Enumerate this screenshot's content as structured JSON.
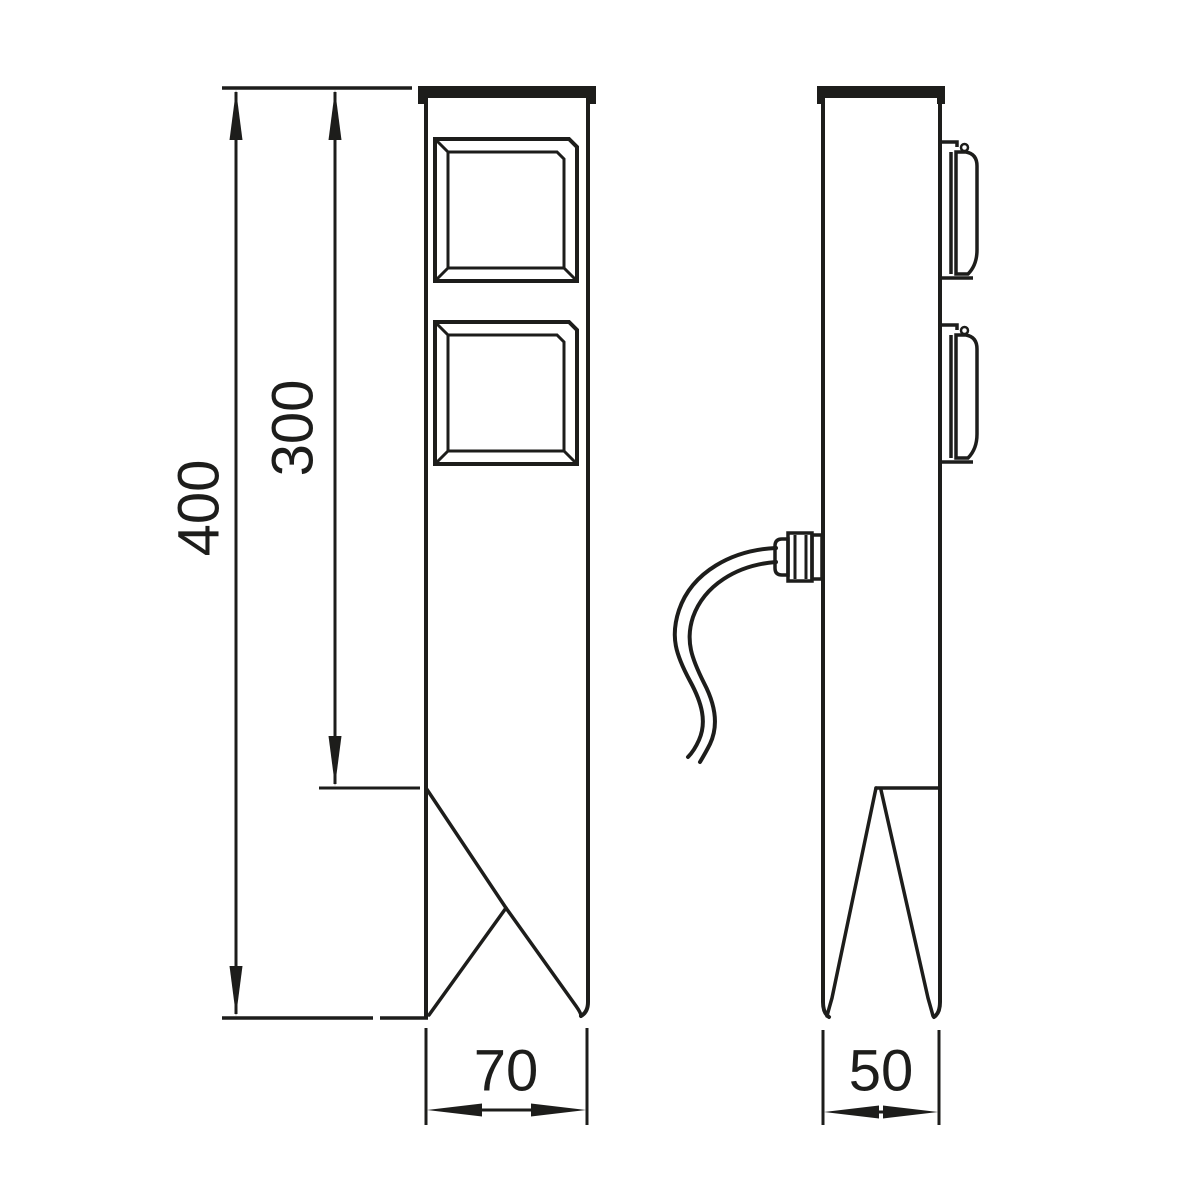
{
  "page": {
    "background": "#ffffff",
    "line_color": "#1d1d1b"
  },
  "drawing": {
    "kind": "technical-drawing-two-views",
    "views": {
      "front_view": "post-with-two-sockets-and-ground-spike",
      "side_view": "post-profile-with-socket-lids-cable-gland-and-spike"
    },
    "dimensions": {
      "total_height": "400",
      "upper_body_height": "300",
      "front_width": "70",
      "side_depth": "50"
    }
  }
}
